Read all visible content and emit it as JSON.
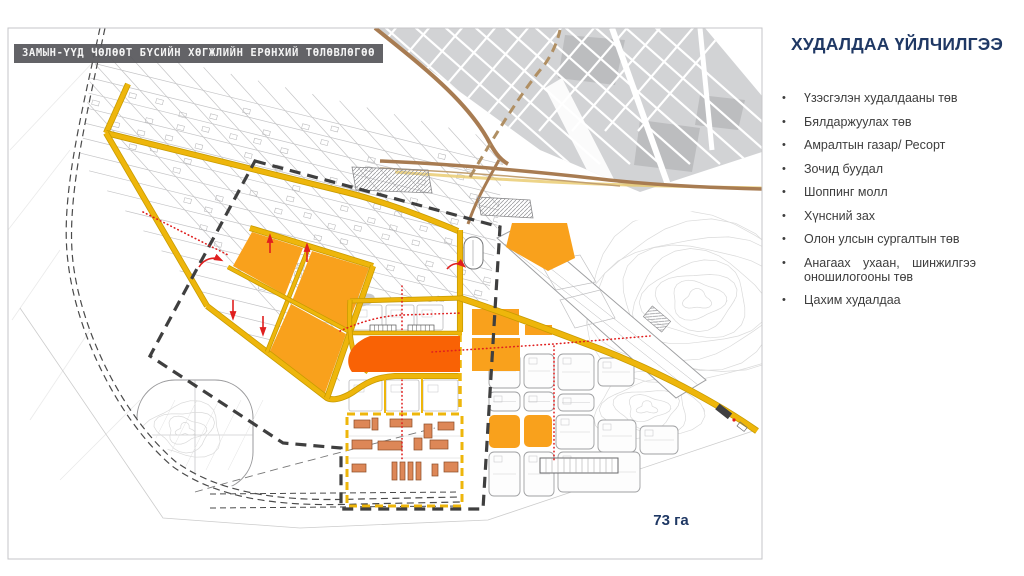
{
  "map": {
    "overlay_title": "ЗАМЫН-ҮҮД ЧӨЛӨӨТ БҮСИЙН ХӨГЖЛИЙН ЕРӨНХИЙ ТӨЛӨВЛӨГӨӨ",
    "area_label": "73 га",
    "colors": {
      "existing_gray": "#d2d3d5",
      "existing_gray_dark": "#bcbdbf",
      "road_yellow": "#eeb60b",
      "road_yellow_edge": "#c89b00",
      "zone_orange": "#f9a11c",
      "zone_highlight": "#f96205",
      "building_salmon": "#dd8757",
      "building_salmon_edge": "#8a4a26",
      "road_brown": "#a87c52",
      "road_brown_light": "#c2a071",
      "boundary_dark": "#3f3f3f",
      "red_accent": "#e01f1f",
      "block_line": "#bababc",
      "contour": "#dadada",
      "heading_blue": "#1f3864"
    }
  },
  "panel": {
    "title": "ХУДАЛДАА ҮЙЛЧИЛГЭЭ",
    "bullets": [
      "Үзэсгэлэн худалдааны төв",
      "Бялдаржуулах төв",
      "Амралтын газар/ Ресорт",
      "Зочид буудал",
      "Шоппинг молл",
      "Хүнсний зах",
      "Олон улсын сургалтын төв",
      "Анагаах ухаан, шинжилгээ оношилогооны төв",
      "Цахим худалдаа"
    ]
  }
}
